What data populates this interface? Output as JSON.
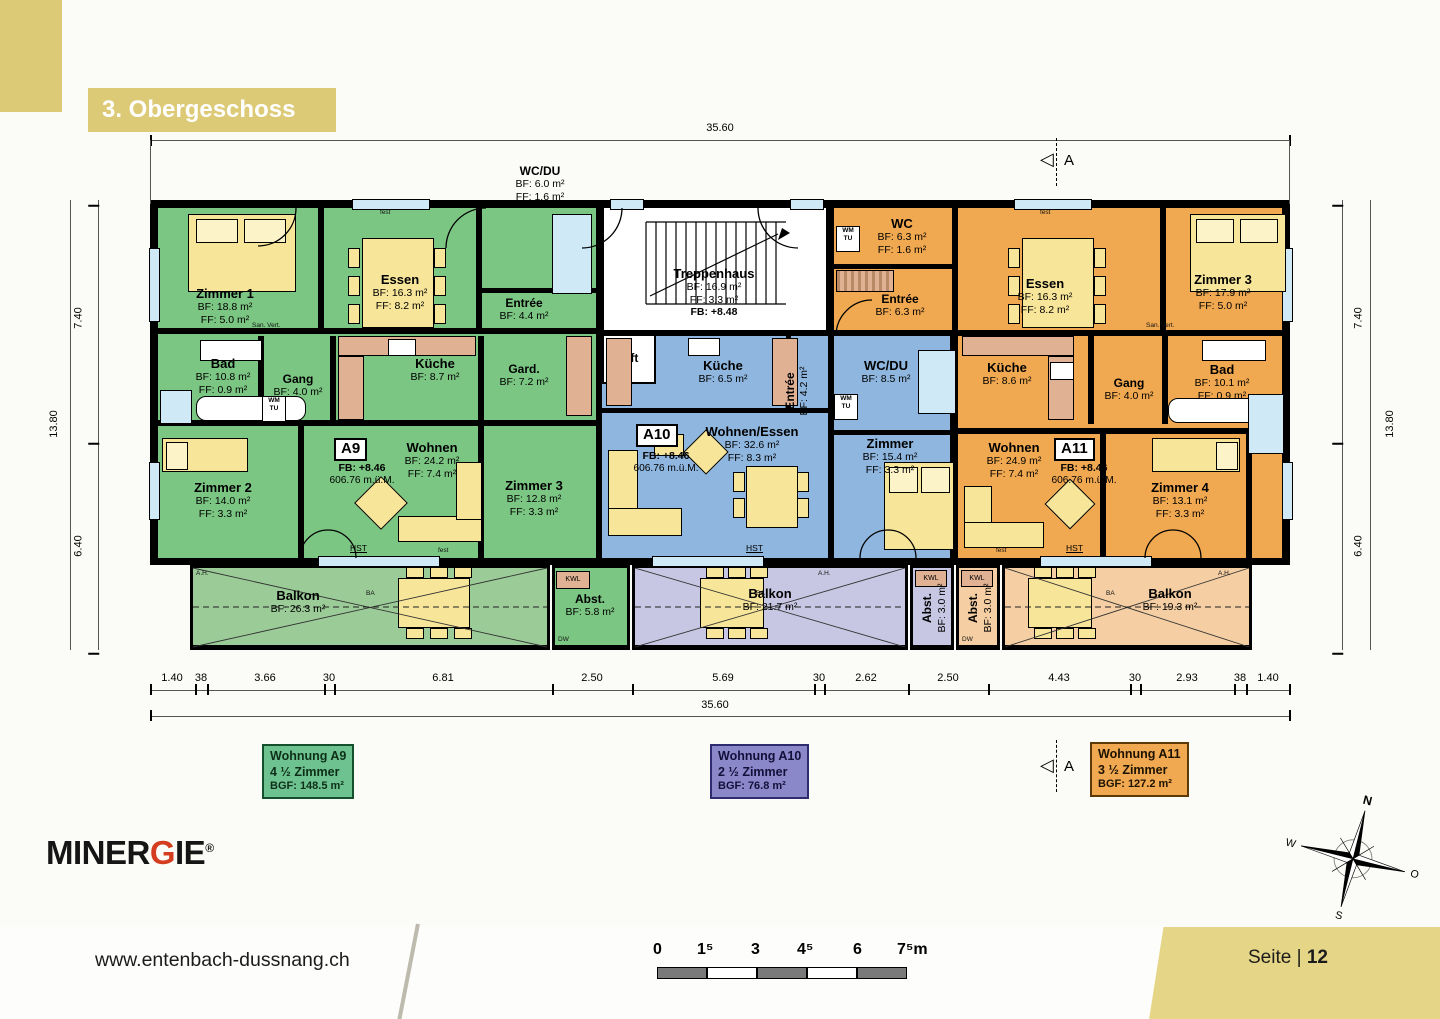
{
  "banner": {
    "title": "3. Obergeschoss"
  },
  "apartments": {
    "a9": {
      "badge": "A9",
      "fb": "FB: +8.46",
      "elevation": "606.76 m.ü.M.",
      "rooms": {
        "zimmer1": {
          "name": "Zimmer 1",
          "l1": "BF: 18.8 m²",
          "l2": "FF: 5.0 m²"
        },
        "essen": {
          "name": "Essen",
          "l1": "BF: 16.3 m²",
          "l2": "FF: 8.2 m²"
        },
        "entree": {
          "name": "Entrée",
          "l1": "BF: 4.4 m²"
        },
        "bad": {
          "name": "Bad",
          "l1": "BF: 10.8 m²",
          "l2": "FF: 0.9 m²"
        },
        "gang": {
          "name": "Gang",
          "l1": "BF: 4.0 m²"
        },
        "kueche": {
          "name": "Küche",
          "l1": "BF: 8.7 m²"
        },
        "gard": {
          "name": "Gard.",
          "l1": "BF: 7.2 m²"
        },
        "zimmer2": {
          "name": "Zimmer 2",
          "l1": "BF: 14.0 m²",
          "l2": "FF: 3.3 m²"
        },
        "wohnen": {
          "name": "Wohnen",
          "l1": "BF: 24.2 m²",
          "l2": "FF: 7.4 m²"
        },
        "zimmer3": {
          "name": "Zimmer 3",
          "l1": "BF: 12.8 m²",
          "l2": "FF: 3.3 m²"
        },
        "balkon": {
          "name": "Balkon",
          "l1": "BF: 26.3 m²"
        },
        "abst": {
          "name": "Abst.",
          "l1": "BF: 5.8 m²"
        }
      }
    },
    "a10": {
      "badge": "A10",
      "fb": "FB: +8.46",
      "elevation": "606.76 m.ü.M.",
      "rooms": {
        "kueche": {
          "name": "Küche",
          "l1": "BF: 6.5 m²"
        },
        "entree": {
          "name": "Entrée",
          "l1": "BF: 4.2 m²"
        },
        "wcdu": {
          "name": "WC/DU",
          "l1": "BF: 8.5 m²"
        },
        "zimmer": {
          "name": "Zimmer",
          "l1": "BF: 15.4 m²",
          "l2": "FF: 3.3 m²"
        },
        "wohnen_essen": {
          "name": "Wohnen/Essen",
          "l1": "BF: 32.6 m²",
          "l2": "FF: 8.3 m²"
        },
        "balkon": {
          "name": "Balkon",
          "l1": "BF: 21.7 m²"
        },
        "abst": {
          "name": "Abst.",
          "l1": "BF: 3.0 m²"
        }
      }
    },
    "a11": {
      "badge": "A11",
      "fb": "FB: +8.46",
      "elevation": "606.76 m.ü.M.",
      "rooms": {
        "wc": {
          "name": "WC",
          "l1": "BF: 6.3 m²",
          "l2": "FF: 1.6 m²"
        },
        "entree": {
          "name": "Entrée",
          "l1": "BF: 6.3 m²"
        },
        "essen": {
          "name": "Essen",
          "l1": "BF: 16.3 m²",
          "l2": "FF: 8.2 m²"
        },
        "zimmer3": {
          "name": "Zimmer 3",
          "l1": "BF: 17.9 m²",
          "l2": "FF: 5.0 m²"
        },
        "kueche": {
          "name": "Küche",
          "l1": "BF: 8.6 m²"
        },
        "gang": {
          "name": "Gang",
          "l1": "BF: 4.0 m²"
        },
        "bad": {
          "name": "Bad",
          "l1": "BF: 10.1 m²",
          "l2": "FF: 0.9 m²"
        },
        "wohnen": {
          "name": "Wohnen",
          "l1": "BF: 24.9 m²",
          "l2": "FF: 7.4 m²"
        },
        "zimmer4": {
          "name": "Zimmer 4",
          "l1": "BF: 13.1 m²",
          "l2": "FF: 3.3 m²"
        },
        "balkon": {
          "name": "Balkon",
          "l1": "BF: 19.3 m²"
        },
        "abst": {
          "name": "Abst.",
          "l1": "BF: 3.0 m²"
        }
      }
    }
  },
  "common": {
    "treppenhaus": {
      "name": "Treppenhaus",
      "l1": "BF: 16.9 m²",
      "l2": "FF: 3.3 m²",
      "l3": "FB: +8.48"
    },
    "lift": "Lift",
    "wcdu_ext": {
      "name": "WC/DU",
      "l1": "BF: 6.0 m²",
      "l2": "FF: 1.6 m²"
    }
  },
  "dims": {
    "top_total": "35.60",
    "bottom_total": "35.60",
    "bottom_chain": [
      "1.40",
      "38",
      "3.66",
      "30",
      "6.81",
      "2.50",
      "5.69",
      "30",
      "2.62",
      "2.50",
      "4.43",
      "30",
      "2.93",
      "38",
      "1.40"
    ],
    "left_total": "13.80",
    "right_total": "13.80",
    "left_upper": "7.40",
    "left_lower": "6.40",
    "right_upper": "7.40",
    "right_lower": "6.40",
    "section_marker": "A"
  },
  "legend": {
    "a9": {
      "title": "Wohnung A9",
      "rooms": "4 ½ Zimmer",
      "bgf": "BGF: 148.5 m²"
    },
    "a10": {
      "title": "Wohnung A10",
      "rooms": "2 ½ Zimmer",
      "bgf": "BGF: 76.8 m²"
    },
    "a11": {
      "title": "Wohnung A11",
      "rooms": "3 ½ Zimmer",
      "bgf": "BGF: 127.2 m²"
    }
  },
  "annotations": {
    "kwl": "KWL",
    "wm": "WM",
    "tu": "TU",
    "hst": "HST",
    "san_vert": "San. Vert.",
    "fest": "fest",
    "ah": "A.H.",
    "ba": "BA",
    "dw": "DW"
  },
  "compass": {
    "n": "N",
    "s": "S",
    "w": "W",
    "o": "O"
  },
  "logo": {
    "part1": "MINER",
    "g": "G",
    "part2": "IE",
    "reg": "®"
  },
  "footer": {
    "url": "www.entenbach-dussnang.ch",
    "page_label": "Seite",
    "page_number": "12",
    "scale_labels": [
      "0",
      "1⁵",
      "3",
      "4⁵",
      "6",
      "7⁵m"
    ]
  },
  "colors": {
    "gold": "#ddca76",
    "green": "#7cc683",
    "green_balkon": "#9bcc97",
    "blue": "#8fb6de",
    "lavender": "#c8c7e3",
    "orange": "#f1a951",
    "orange_balkon": "#f5cfa3",
    "furniture": "#f7e59a",
    "counter": "#e0b193",
    "window": "#cfe9f6"
  }
}
